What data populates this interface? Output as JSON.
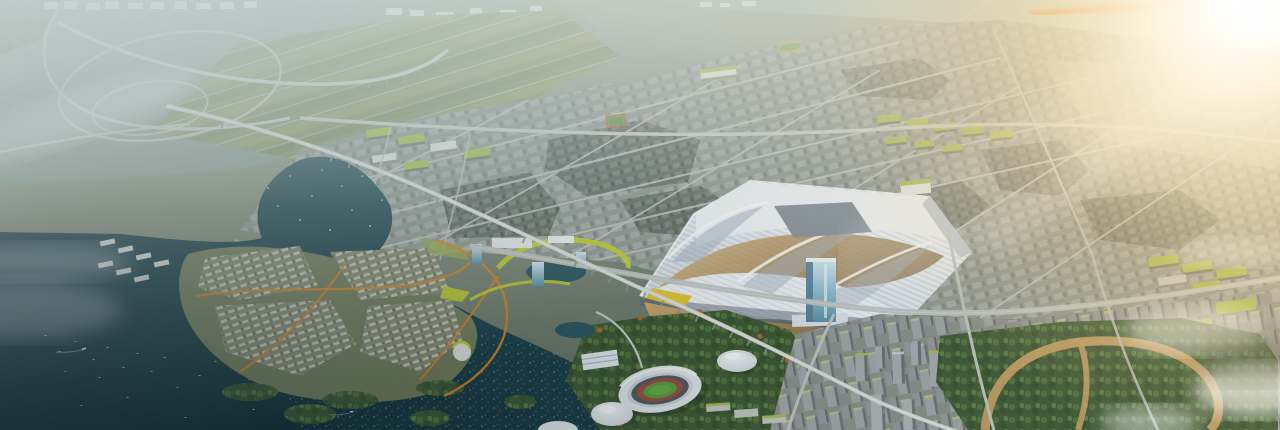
{
  "meta": {
    "title": "Aerial masterplan rendering of a riverside city district at golden hour",
    "view": "oblique aerial rendering",
    "visible_text": "none"
  },
  "canvas": {
    "width": 1280,
    "height": 430
  },
  "palette": {
    "land": "#87917f",
    "haze": "#d2dcd9",
    "far_water": "#9db3b4",
    "lake_deep": "#122b34",
    "lake_mid": "#2e5f66",
    "field_green": "#8a9668",
    "field_yellow": "#9aa06b",
    "road": "#c6cbc7",
    "viaduct": "#d6dad6",
    "city_block": "#99a09a",
    "city_dark": "#636b64",
    "roof_green": "#aac14f",
    "chartreuse": "#c5d42f",
    "expo_white": "#eef2f5",
    "expo_shadow": "#aab7c2",
    "plaza_tan": "#c9a164",
    "path_orange": "#d8892c",
    "glass_blue": "#8fb9cc",
    "stadium_pitch": "#5aa23c",
    "stadium_track": "#9c4f44",
    "dome_white": "#e8edf0",
    "park_path_tan": "#c8a268",
    "forest_green": "#415c36",
    "cloud_white": "#ffffff",
    "sun_core": "#ffffff",
    "sun_warm": "#ffe9bc",
    "sun_orange": "#f0a24a"
  },
  "scene": {
    "landmarks": [
      {
        "id": "exhibition-center",
        "label": "wave-roofed exhibition center with glass tower"
      },
      {
        "id": "stadium",
        "label": "oval stadium with green pitch"
      },
      {
        "id": "arena-domes",
        "label": "two round white arenas"
      },
      {
        "id": "lake",
        "label": "dark lake with islands, boats and bird flock"
      },
      {
        "id": "lakeside-village",
        "label": "low-rise lakeside village with orange paths"
      },
      {
        "id": "interchange",
        "label": "looping highway interchange in morning haze"
      },
      {
        "id": "rail-viaduct",
        "label": "elevated rail viaduct crossing the district"
      },
      {
        "id": "city-grid",
        "label": "dense mid-rise urban grid fading into sunlight"
      },
      {
        "id": "east-forest-park",
        "label": "forest park with tan loop path"
      },
      {
        "id": "sun-glare",
        "label": "golden sun glare from the upper right corner"
      }
    ]
  }
}
